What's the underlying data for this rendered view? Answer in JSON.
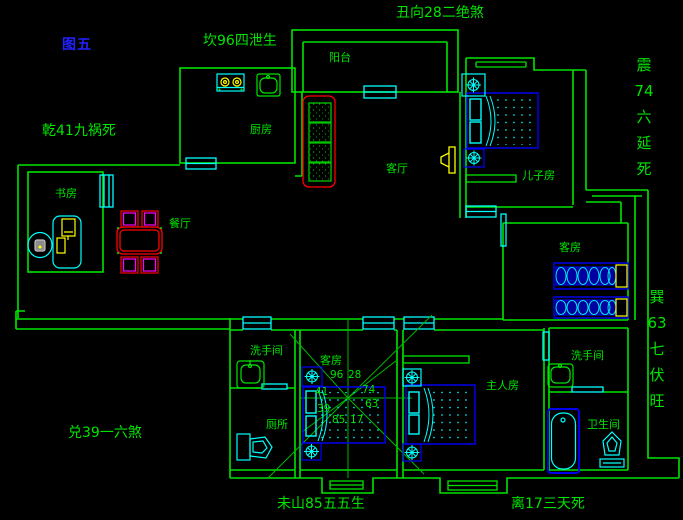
{
  "figure_label": "图五",
  "annotations": {
    "kan": "坎96四泄生",
    "chou": "丑向28二绝煞",
    "qian": "乾41九祸死",
    "zhen": "震74六延死",
    "xun": "巽63七伏旺",
    "dui": "兑39一六煞",
    "wei": "未山85五五生",
    "li": "离17三天死"
  },
  "rooms": {
    "balcony": "阳台",
    "kitchen": "厨房",
    "living": "客厅",
    "son_room": "儿子房",
    "guest_right": "客房",
    "study": "书房",
    "dining": "餐厅",
    "washroom_left": "洗手间",
    "toilet": "厕所",
    "guest_bottom": "客房",
    "master": "主人房",
    "washroom_right": "洗手间",
    "bathroom": "卫生间"
  },
  "compass_numbers": {
    "top_left": "96",
    "top_right": "28",
    "right_upper": "74",
    "right_lower": "63",
    "bottom_right": "17",
    "bottom_left": "85",
    "left_lower": "39",
    "left_upper": "41"
  },
  "colors": {
    "wall_green": "#00e400",
    "window_cyan": "#00ffff",
    "furniture_blue": "#0000ff",
    "accent_yellow": "#ffff00",
    "accent_red": "#ff0000",
    "accent_magenta": "#ff00ff",
    "figure_label_blue": "#2222ff",
    "background": "#000000"
  }
}
